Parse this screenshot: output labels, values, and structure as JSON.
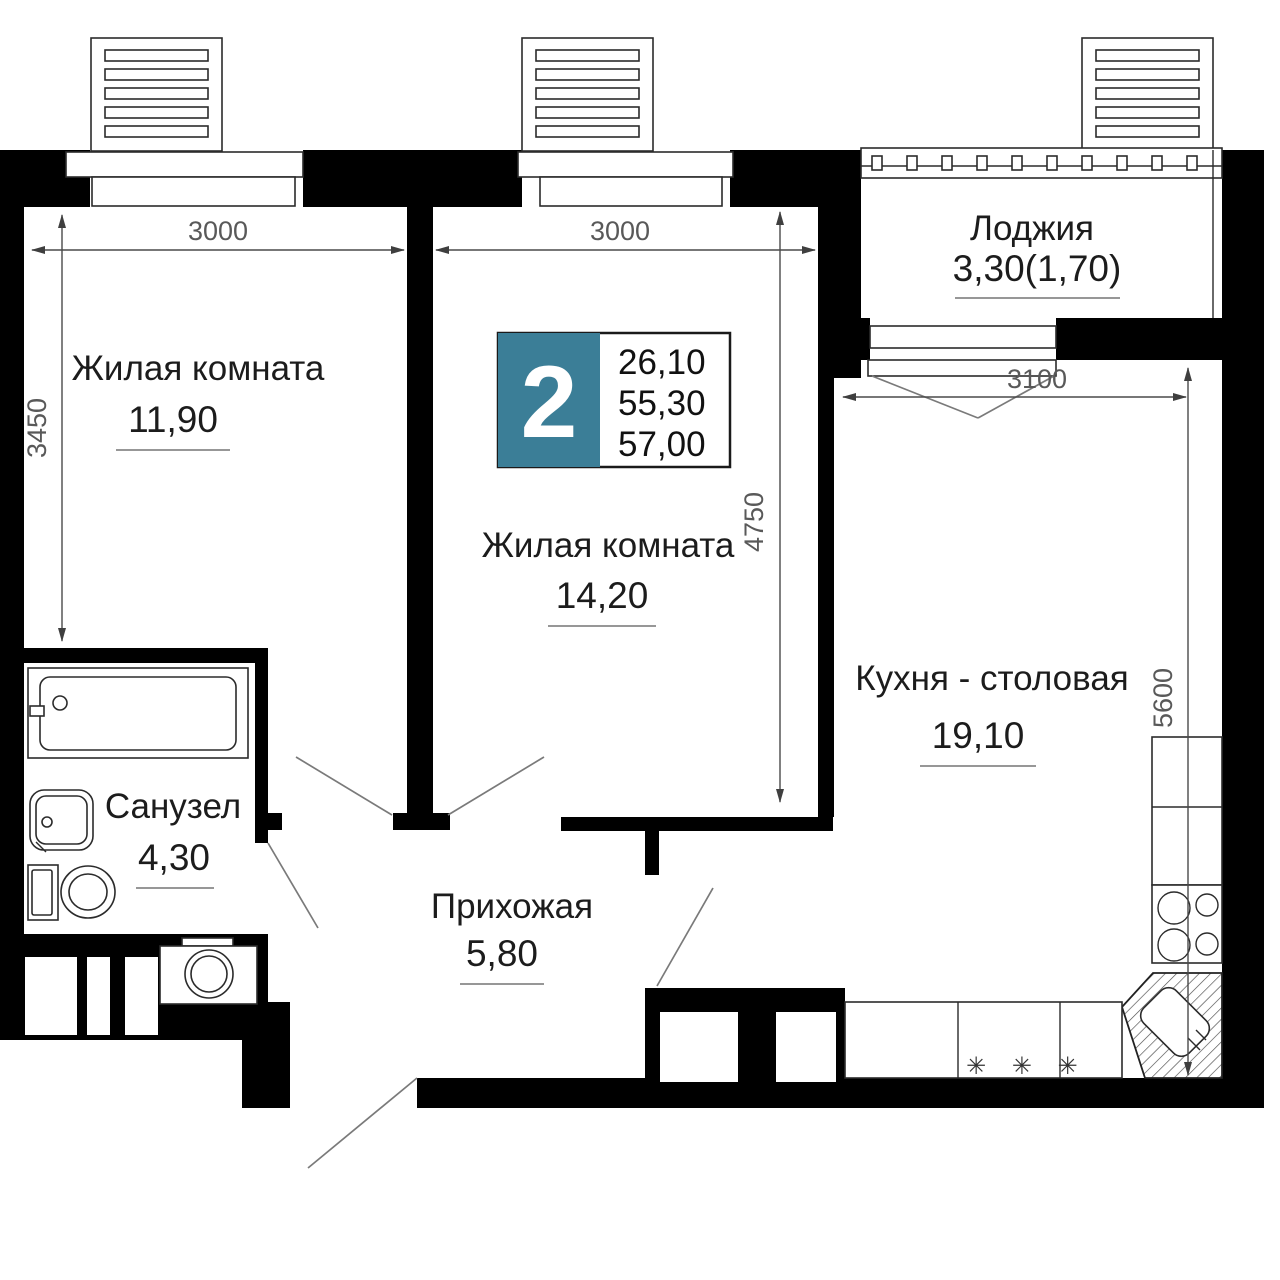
{
  "plan": {
    "badge": {
      "rooms_count": "2",
      "area_living": "26,10",
      "area_no_balcony": "55,30",
      "area_total": "57,00"
    },
    "rooms": {
      "room1": {
        "label": "Жилая комната",
        "area": "11,90"
      },
      "room2": {
        "label": "Жилая комната",
        "area": "14,20"
      },
      "loggia": {
        "label": "Лоджия",
        "area": "3,30(1,70)"
      },
      "kitchen": {
        "label": "Кухня - столовая",
        "area": "19,10"
      },
      "bathroom": {
        "label": "Санузел",
        "area": "4,30"
      },
      "hallway": {
        "label": "Прихожая",
        "area": "5,80"
      }
    },
    "dimensions": {
      "room1_width": "3000",
      "room2_width": "3000",
      "kitchen_width": "3100",
      "room1_depth": "3450",
      "room2_depth": "4750",
      "kitchen_depth": "5600"
    },
    "symbols": {
      "hob": "✳ ✳ ✳"
    },
    "colors": {
      "wall": "#000000",
      "badge": "#3B7E97",
      "dim": "#595959"
    }
  }
}
